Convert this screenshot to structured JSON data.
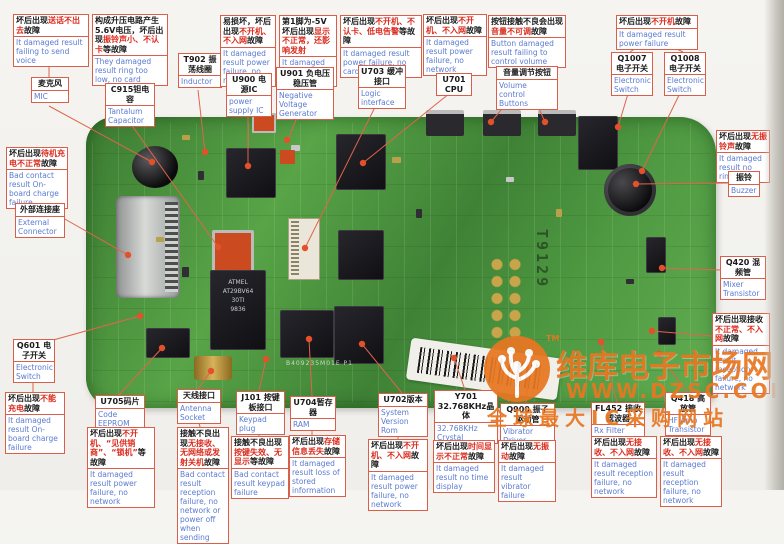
{
  "colors": {
    "accent_border": "#d95f4a",
    "fault_red": "#db2b1d",
    "english_blue": "#5a7bd0",
    "watermark_orange": "#e87722",
    "board_green": "#4a8a3c",
    "wire": "#e0654a",
    "dot": "#e4502a"
  },
  "watermark": {
    "tm": "TM",
    "brand": "维库电子市场网",
    "url": "WWW.DZSC.COM",
    "slogan": "全球最大IC采购网站"
  },
  "board": {
    "vertical_label": "T9129",
    "silkscreen": "B409235M01E  P1",
    "chip_lines": [
      "ATMEL",
      "AT29BV64",
      "30TI",
      "9836"
    ]
  },
  "callouts": [
    {
      "id": "mic-fault",
      "x": 13,
      "y": 14,
      "w": 74,
      "cn": [
        [
          "坏后出现",
          "k"
        ],
        [
          "送话不出去",
          "r"
        ],
        [
          "故障",
          "k"
        ]
      ],
      "en": "It damaged result failing to send voice"
    },
    {
      "id": "mic",
      "comp": true,
      "x": 31,
      "y": 77,
      "w": 36,
      "cn": [
        [
          "麦克风",
          "k"
        ]
      ],
      "en": "MIC"
    },
    {
      "id": "c915-fault",
      "x": 92,
      "y": 14,
      "w": 74,
      "cn": [
        [
          "构成升压电路产生5.6V电压，坏后出现",
          "k"
        ],
        [
          "振铃声小、不认卡",
          "r"
        ],
        [
          "等故障",
          "k"
        ]
      ],
      "en": "They damaged result ring too low, no card"
    },
    {
      "id": "c915",
      "comp": true,
      "x": 105,
      "y": 83,
      "w": 48,
      "cn": [
        [
          "C915钽电容",
          "k"
        ]
      ],
      "en": "Tantalum Capacitor"
    },
    {
      "id": "t902",
      "comp": true,
      "x": 178,
      "y": 53,
      "w": 42,
      "cn": [
        [
          "T902 振荡线圈",
          "k"
        ]
      ],
      "en": "Inductor"
    },
    {
      "id": "u900-fault",
      "x": 220,
      "y": 15,
      "w": 54,
      "cn": [
        [
          "易损坏，坏后出现",
          "k"
        ],
        [
          "不开机、不入网",
          "r"
        ],
        [
          "故障",
          "k"
        ]
      ],
      "en": "It damaged result power failure, no network"
    },
    {
      "id": "u900",
      "comp": true,
      "x": 226,
      "y": 73,
      "w": 44,
      "cn": [
        [
          "U900 电源IC",
          "k"
        ]
      ],
      "en": "power supply IC"
    },
    {
      "id": "u901-fault",
      "x": 279,
      "y": 15,
      "w": 56,
      "cn": [
        [
          "第1脚为-5V坏后出现",
          "k"
        ],
        [
          "显示不正常，还影响发射",
          "r"
        ]
      ],
      "en": "It damaged result no display"
    },
    {
      "id": "u901",
      "comp": true,
      "x": 276,
      "y": 67,
      "w": 56,
      "cn": [
        [
          "U901 负电压稳压管",
          "k"
        ]
      ],
      "en": "Negative Voltage Generator"
    },
    {
      "id": "u703-fault",
      "x": 340,
      "y": 15,
      "w": 80,
      "cn": [
        [
          "坏后出现",
          "k"
        ],
        [
          "不开机、不认卡、低电告警",
          "r"
        ],
        [
          "等故障",
          "k"
        ]
      ],
      "en": "It damaged result power failure, no card"
    },
    {
      "id": "u703",
      "comp": true,
      "x": 358,
      "y": 65,
      "w": 46,
      "cn": [
        [
          "U703 缓冲接口",
          "k"
        ]
      ],
      "en": "Logic interface"
    },
    {
      "id": "u701-fault",
      "x": 423,
      "y": 14,
      "w": 62,
      "cn": [
        [
          "坏后出现",
          "k"
        ],
        [
          "不开机、不入网",
          "r"
        ],
        [
          "故障",
          "k"
        ]
      ],
      "en": "It damaged result power failure, no network"
    },
    {
      "id": "u701",
      "comp": true,
      "x": 436,
      "y": 73,
      "w": 34,
      "cn": [
        [
          "U701 CPU",
          "k"
        ]
      ]
    },
    {
      "id": "vol-fault",
      "x": 488,
      "y": 15,
      "w": 76,
      "cn": [
        [
          "按钮接触不良会出现",
          "k"
        ],
        [
          "音量不可调",
          "r"
        ],
        [
          "故障",
          "k"
        ]
      ],
      "en": "Button damaged result failing to control volume"
    },
    {
      "id": "vol",
      "comp": true,
      "x": 496,
      "y": 66,
      "w": 60,
      "cn": [
        [
          "音量调节按钮",
          "k"
        ]
      ],
      "en": "Volume control Buttons"
    },
    {
      "id": "q1007-fault",
      "x": 616,
      "y": 15,
      "w": 80,
      "cn": [
        [
          "坏后出现",
          "k"
        ],
        [
          "不开机",
          "r"
        ],
        [
          "故障",
          "k"
        ]
      ],
      "en": "It damaged result power failure"
    },
    {
      "id": "q1007",
      "comp": true,
      "x": 611,
      "y": 52,
      "w": 40,
      "cn": [
        [
          "Q1007 电子开关",
          "k"
        ]
      ],
      "en": "Electronic Switch"
    },
    {
      "id": "q1008",
      "comp": true,
      "x": 664,
      "y": 52,
      "w": 40,
      "cn": [
        [
          "Q1008 电子开关",
          "k"
        ]
      ],
      "en": "Electronic Switch"
    },
    {
      "id": "buzzer-fault",
      "x": 716,
      "y": 130,
      "w": 52,
      "cn": [
        [
          "坏后出现",
          "k"
        ],
        [
          "无振铃声",
          "r"
        ],
        [
          "故障",
          "k"
        ]
      ],
      "en": "It damaged result no ring"
    },
    {
      "id": "buzzer",
      "comp": true,
      "x": 728,
      "y": 171,
      "w": 30,
      "cn": [
        [
          "振铃",
          "k"
        ]
      ],
      "en": "Buzzer"
    },
    {
      "id": "q420",
      "comp": true,
      "x": 720,
      "y": 256,
      "w": 44,
      "cn": [
        [
          "Q420 混频管",
          "k"
        ]
      ],
      "en": "Mixer Transistor"
    },
    {
      "id": "rx-fault",
      "x": 712,
      "y": 313,
      "w": 56,
      "cn": [
        [
          "坏后出现接收",
          "k"
        ],
        [
          "不正常、不入网",
          "r"
        ],
        [
          "故障",
          "k"
        ]
      ],
      "en": "It damaged result reception failure, no network"
    },
    {
      "id": "ext-fault",
      "x": 6,
      "y": 147,
      "w": 60,
      "cn": [
        [
          "坏后出现",
          "k"
        ],
        [
          "待机充电不正常",
          "r"
        ],
        [
          "故障",
          "k"
        ]
      ],
      "en": "Bad contact result On-board charge failure"
    },
    {
      "id": "ext",
      "comp": true,
      "x": 15,
      "y": 203,
      "w": 48,
      "cn": [
        [
          "外部连接座",
          "k"
        ]
      ],
      "en": "External Connector"
    },
    {
      "id": "q601",
      "comp": true,
      "x": 13,
      "y": 339,
      "w": 40,
      "cn": [
        [
          "Q601 电子开关",
          "k"
        ]
      ],
      "en": "Electronic Switch"
    },
    {
      "id": "q601-fault",
      "x": 5,
      "y": 392,
      "w": 58,
      "cn": [
        [
          "坏后出现",
          "k"
        ],
        [
          "不能充电",
          "r"
        ],
        [
          "故障",
          "k"
        ]
      ],
      "en": "It damaged result On-board charge failure"
    },
    {
      "id": "u705",
      "comp": true,
      "x": 95,
      "y": 395,
      "w": 48,
      "cn": [
        [
          "U705码片",
          "k"
        ]
      ],
      "en": "Code EEPROM"
    },
    {
      "id": "u705-fault",
      "x": 87,
      "y": 427,
      "w": 66,
      "cn": [
        [
          "坏后出现",
          "k"
        ],
        [
          "不开机、“见供销商”、“锁机”",
          "r"
        ],
        [
          "等故障",
          "k"
        ]
      ],
      "en": "It damaged result power failure, no network"
    },
    {
      "id": "antenna",
      "comp": true,
      "x": 177,
      "y": 389,
      "w": 42,
      "cn": [
        [
          "天线接口",
          "k"
        ]
      ],
      "en": "Antenna Socket"
    },
    {
      "id": "antenna-fault",
      "x": 177,
      "y": 427,
      "w": 50,
      "cn": [
        [
          "接触不良出现",
          "k"
        ],
        [
          "无接收、无网络或发射关机",
          "r"
        ],
        [
          "故障",
          "k"
        ]
      ],
      "en": "Bad contact result reception failure, no network or power off when sending"
    },
    {
      "id": "j101",
      "comp": true,
      "x": 236,
      "y": 391,
      "w": 47,
      "cn": [
        [
          "J101 按键板接口",
          "k"
        ]
      ],
      "en": "Keypad plug"
    },
    {
      "id": "j101-fault",
      "x": 231,
      "y": 436,
      "w": 56,
      "cn": [
        [
          "接触不良出现",
          "k"
        ],
        [
          "按键失效、无显示",
          "r"
        ],
        [
          "等故障",
          "k"
        ]
      ],
      "en": "Bad contact result keypad failure"
    },
    {
      "id": "u704",
      "comp": true,
      "x": 290,
      "y": 396,
      "w": 44,
      "cn": [
        [
          "U704暂存器",
          "k"
        ]
      ],
      "en": "RAM"
    },
    {
      "id": "u704-fault",
      "x": 289,
      "y": 435,
      "w": 55,
      "cn": [
        [
          "坏后出现",
          "k"
        ],
        [
          "存储信息丢失",
          "r"
        ],
        [
          "故障",
          "k"
        ]
      ],
      "en": "It damaged result loss of stored information"
    },
    {
      "id": "u702",
      "comp": true,
      "x": 378,
      "y": 393,
      "w": 48,
      "cn": [
        [
          "U702版本",
          "k"
        ]
      ],
      "en": "System Version Rom"
    },
    {
      "id": "u702-fault",
      "x": 368,
      "y": 439,
      "w": 58,
      "cn": [
        [
          "坏后出现",
          "k"
        ],
        [
          "不开机、不入网",
          "r"
        ],
        [
          "故障",
          "k"
        ]
      ],
      "en": "It damaged result power failure, no network"
    },
    {
      "id": "y701",
      "comp": true,
      "x": 434,
      "y": 390,
      "w": 62,
      "cn": [
        [
          "Y701 32.768KHz晶体",
          "k"
        ]
      ],
      "en": "32.768KHz Crystal"
    },
    {
      "id": "y701-fault",
      "x": 433,
      "y": 440,
      "w": 60,
      "cn": [
        [
          "坏后出现",
          "k"
        ],
        [
          "时间显示不正常",
          "r"
        ],
        [
          "故障",
          "k"
        ]
      ],
      "en": "It damaged result no time display"
    },
    {
      "id": "q900",
      "comp": true,
      "x": 500,
      "y": 403,
      "w": 53,
      "cn": [
        [
          "Q900 振子驱动管",
          "k"
        ]
      ],
      "en": "Vibrator Driver"
    },
    {
      "id": "q900-fault",
      "x": 498,
      "y": 440,
      "w": 56,
      "cn": [
        [
          "坏后出现",
          "k"
        ],
        [
          "无振动",
          "r"
        ],
        [
          "故障",
          "k"
        ]
      ],
      "en": "It damaged result vibrator failure"
    },
    {
      "id": "fl452",
      "comp": true,
      "x": 591,
      "y": 402,
      "w": 52,
      "cn": [
        [
          "FL452 接收滤波器",
          "k"
        ]
      ],
      "en": "Rx Filter"
    },
    {
      "id": "fl452-fault",
      "x": 591,
      "y": 436,
      "w": 64,
      "cn": [
        [
          "坏后出现",
          "k"
        ],
        [
          "无接收、不入网",
          "r"
        ],
        [
          "故障",
          "k"
        ]
      ],
      "en": "It damaged result reception failure, no network"
    },
    {
      "id": "q418",
      "comp": true,
      "x": 665,
      "y": 392,
      "w": 44,
      "cn": [
        [
          "Q418 高放管",
          "k"
        ]
      ],
      "en": "HF Amp Transistor"
    },
    {
      "id": "q418-fault",
      "x": 660,
      "y": 436,
      "w": 60,
      "cn": [
        [
          "坏后出现",
          "k"
        ],
        [
          "无接收、不入网",
          "r"
        ],
        [
          "故障",
          "k"
        ]
      ],
      "en": "It damaged result reception failure, no network"
    }
  ],
  "wires": [
    [
      49,
      57,
      49,
      77
    ],
    [
      49,
      106,
      152,
      162
    ],
    [
      128,
      72,
      128,
      83
    ],
    [
      128,
      120,
      218,
      247
    ],
    [
      198,
      90,
      205,
      152
    ],
    [
      246,
      68,
      246,
      73
    ],
    [
      248,
      103,
      248,
      166
    ],
    [
      305,
      60,
      305,
      67
    ],
    [
      303,
      102,
      288,
      140
    ],
    [
      380,
      55,
      380,
      65
    ],
    [
      380,
      97,
      306,
      246
    ],
    [
      452,
      57,
      452,
      73
    ],
    [
      450,
      93,
      363,
      163
    ],
    [
      525,
      60,
      525,
      66
    ],
    [
      515,
      93,
      491,
      122
    ],
    [
      532,
      93,
      545,
      122
    ],
    [
      645,
      42,
      630,
      52
    ],
    [
      662,
      42,
      683,
      52
    ],
    [
      630,
      87,
      618,
      127
    ],
    [
      683,
      87,
      642,
      171
    ],
    [
      742,
      163,
      742,
      171
    ],
    [
      728,
      183,
      636,
      184
    ],
    [
      720,
      270,
      662,
      268
    ],
    [
      712,
      336,
      652,
      331
    ],
    [
      34,
      192,
      34,
      203
    ],
    [
      63,
      218,
      128,
      255
    ],
    [
      46,
      342,
      140,
      316
    ],
    [
      33,
      373,
      33,
      392
    ],
    [
      119,
      395,
      162,
      348
    ],
    [
      119,
      423,
      119,
      427
    ],
    [
      198,
      389,
      211,
      371
    ],
    [
      198,
      418,
      200,
      427
    ],
    [
      259,
      391,
      266,
      359
    ],
    [
      259,
      417,
      259,
      436
    ],
    [
      312,
      396,
      309,
      339
    ],
    [
      312,
      417,
      312,
      435
    ],
    [
      402,
      393,
      362,
      344
    ],
    [
      398,
      428,
      398,
      439
    ],
    [
      465,
      390,
      454,
      358
    ],
    [
      463,
      430,
      463,
      440
    ],
    [
      526,
      403,
      531,
      342
    ],
    [
      525,
      434,
      525,
      440
    ],
    [
      617,
      402,
      601,
      342
    ],
    [
      618,
      429,
      618,
      436
    ],
    [
      687,
      392,
      659,
      354
    ],
    [
      687,
      428,
      689,
      436
    ]
  ],
  "dots": [
    [
      152,
      162
    ],
    [
      218,
      247
    ],
    [
      205,
      152
    ],
    [
      248,
      166
    ],
    [
      287,
      140
    ],
    [
      305,
      248
    ],
    [
      363,
      163
    ],
    [
      491,
      122
    ],
    [
      545,
      122
    ],
    [
      618,
      127
    ],
    [
      642,
      171
    ],
    [
      636,
      184
    ],
    [
      662,
      268
    ],
    [
      652,
      331
    ],
    [
      128,
      255
    ],
    [
      140,
      316
    ],
    [
      162,
      348
    ],
    [
      211,
      371
    ],
    [
      266,
      359
    ],
    [
      309,
      339
    ],
    [
      362,
      344
    ],
    [
      454,
      358
    ],
    [
      531,
      342
    ],
    [
      601,
      342
    ],
    [
      659,
      354
    ]
  ]
}
